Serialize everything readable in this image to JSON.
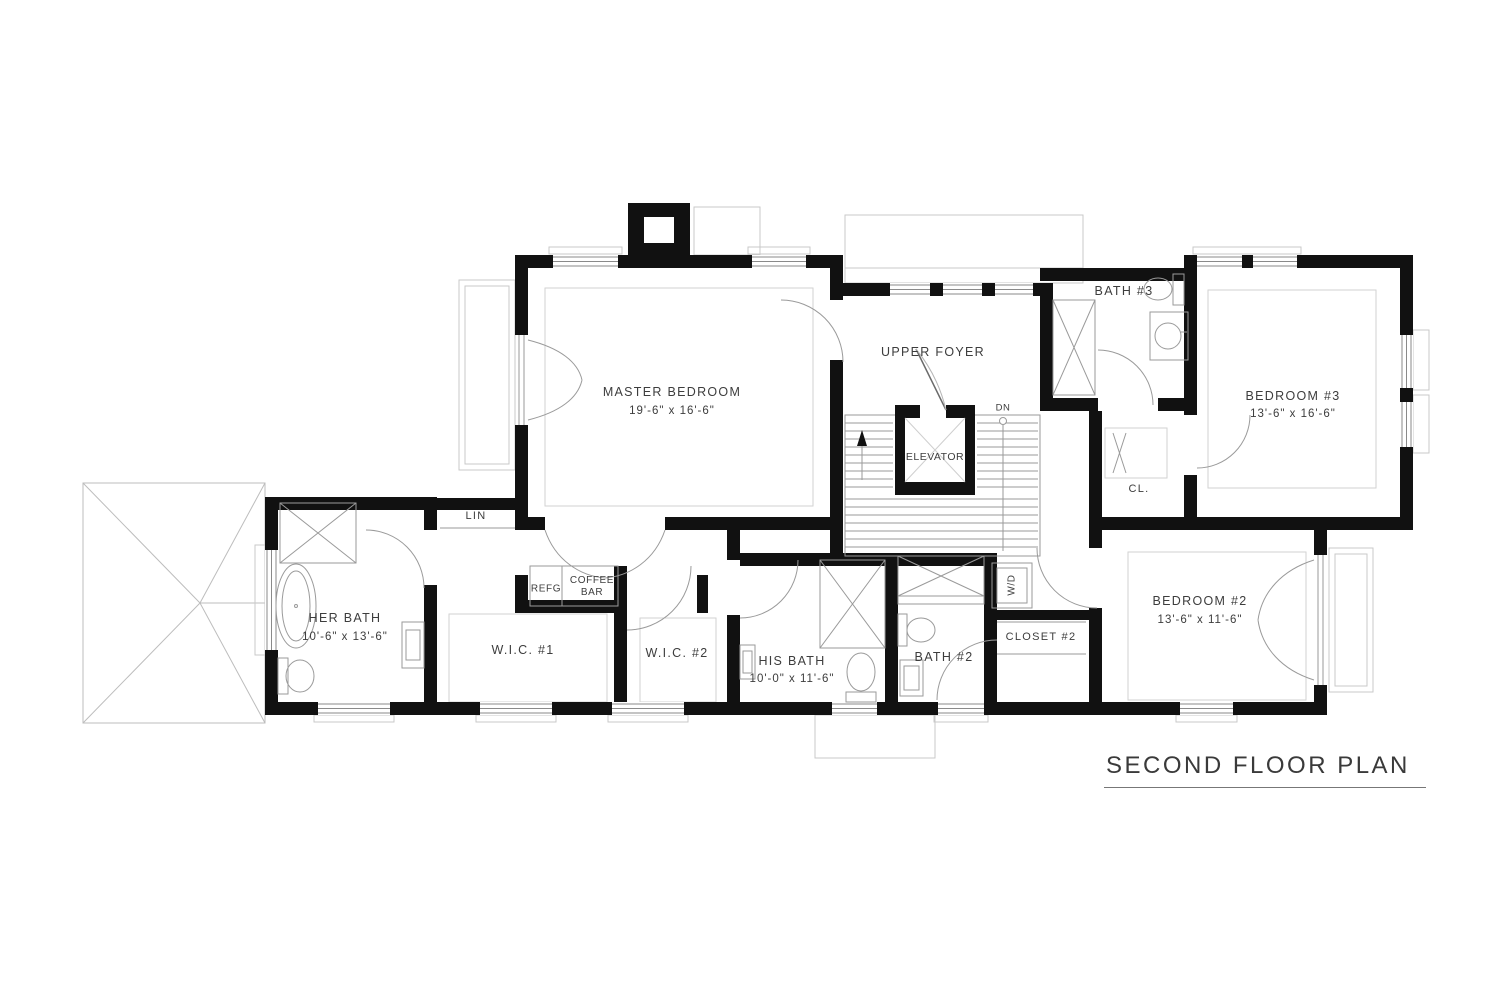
{
  "title": "SECOND FLOOR PLAN",
  "colors": {
    "wall": "#111111",
    "thin_line": "#9a9a9a",
    "light_line": "#c9c9c9",
    "text": "#3d3d3d"
  },
  "rooms": {
    "master_bedroom": {
      "name": "MASTER BEDROOM",
      "dims": "19'-6\" x 16'-6\""
    },
    "upper_foyer": {
      "name": "UPPER FOYER"
    },
    "elevator": {
      "name": "ELEVATOR"
    },
    "bath_3": {
      "name": "BATH #3"
    },
    "bedroom_3": {
      "name": "BEDROOM #3",
      "dims": "13'-6\" x 16'-6\""
    },
    "closet": {
      "name": "CL."
    },
    "linen": {
      "name": "LIN"
    },
    "her_bath": {
      "name": "HER BATH",
      "dims": "10'-6\" x 13'-6\""
    },
    "wic_1": {
      "name": "W.I.C. #1"
    },
    "refrigerator": {
      "name": "REFG"
    },
    "coffee_bar": {
      "name": "COFFEE BAR"
    },
    "wic_2": {
      "name": "W.I.C. #2"
    },
    "his_bath": {
      "name": "HIS BATH",
      "dims": "10'-0\" x 11'-6\""
    },
    "bath_2": {
      "name": "BATH #2"
    },
    "washer_dryer": {
      "name": "W/D"
    },
    "closet_2": {
      "name": "CLOSET #2"
    },
    "bedroom_2": {
      "name": "BEDROOM #2",
      "dims": "13'-6\" x 11'-6\""
    }
  },
  "annotations": {
    "stairs_down": "DN"
  }
}
